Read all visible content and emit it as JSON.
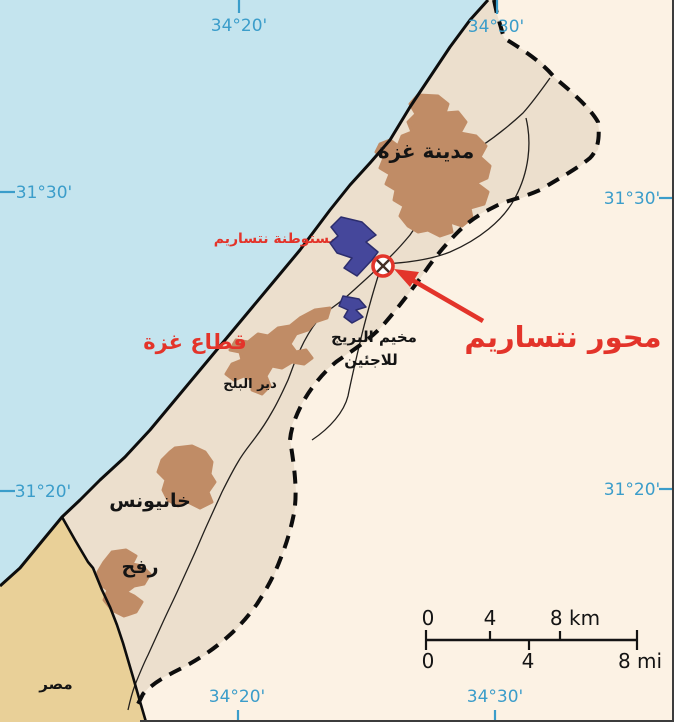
{
  "labels": {
    "gaza_city": "مدينة غزة",
    "gaza_strip": "قطاع غزة",
    "khan_yunis": "خانيونس",
    "rafah": "رفح",
    "deir_al_balah": "دير البلح",
    "bureij_camp_line1": "مخيم البريج",
    "bureij_camp_line2": "للاجئين",
    "egypt": "مصر",
    "netzarim_settlement": "مستوطنة نتساريم",
    "netzarim_corridor": "محور نتساريم"
  },
  "graticule": {
    "top_west": "34°20'",
    "top_east": "34°30'",
    "bottom_west": "34°20'",
    "bottom_east": "34°30'",
    "left_north": "31°30'",
    "left_south": "31°20'",
    "right_north": "31°30'",
    "right_south": "31°20'"
  },
  "scale_bar": {
    "km_0": "0",
    "km_4": "4",
    "km_8": "8 km",
    "mi_0": "0",
    "mi_4": "4",
    "mi_8": "8 mi"
  },
  "colors": {
    "sea": "#c4e4ee",
    "gaza_strip_fill": "#ecdfcd",
    "outside_fill": "#fcf2e4",
    "egypt_fill": "#e9d098",
    "urban_fill": "#c08c66",
    "settlement_fill": "#45479b",
    "accent_red": "#e3342a",
    "graticule_blue": "#3b9dca"
  }
}
